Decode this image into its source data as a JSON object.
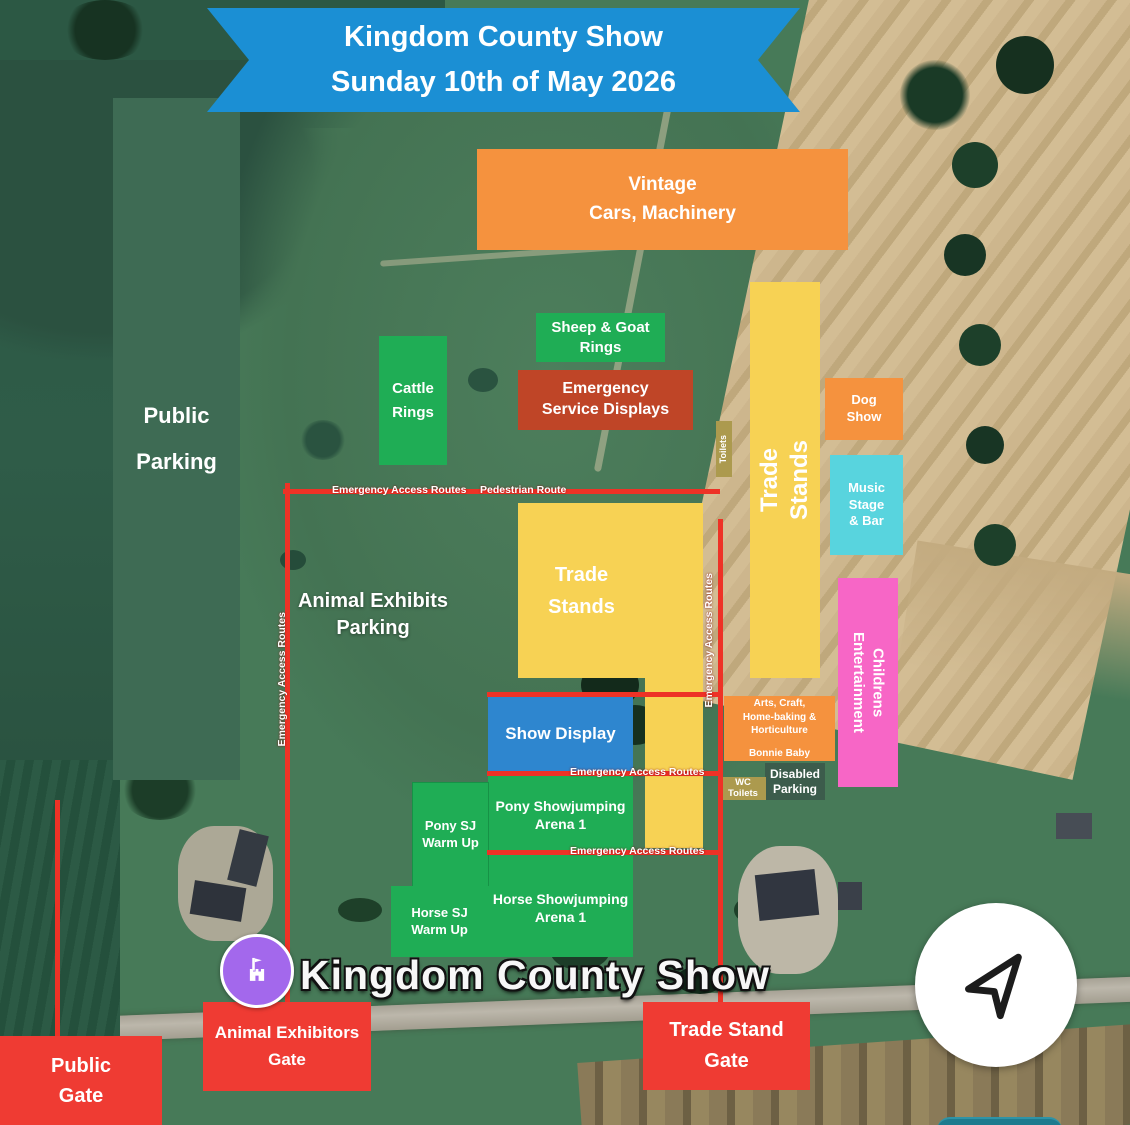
{
  "banner": {
    "line1": "Kingdom County Show",
    "line2": "Sunday 10th of May 2026",
    "color": "#1b8fd4"
  },
  "zones": {
    "public_parking": {
      "line1": "Public",
      "line2": "Parking",
      "color": "#3e6b54"
    },
    "vintage": {
      "line1": "Vintage",
      "line2": "Cars, Machinery",
      "color": "#f5923e"
    },
    "cattle_rings": {
      "line1": "Cattle",
      "line2": "Rings",
      "color": "#1fad55"
    },
    "sheep_goat_rings": {
      "line1": "Sheep & Goat",
      "line2": "Rings",
      "color": "#1fad55"
    },
    "emergency_service_displays": {
      "line1": "Emergency",
      "line2": "Service Displays",
      "color": "#bf4527"
    },
    "toilets": {
      "label": "Toilets",
      "color": "#ac9a4e"
    },
    "trade_stands_right": {
      "line1": "Trade",
      "line2": "Stands",
      "color": "#f7d254"
    },
    "dog_show": {
      "line1": "Dog",
      "line2": "Show",
      "color": "#f5923e"
    },
    "music_stage_bar": {
      "line1": "Music Stage",
      "line2": "& Bar",
      "color": "#58d4de"
    },
    "childrens_entertainment": {
      "line1": "Childrens",
      "line2": "Entertainment",
      "color": "#f766c6"
    },
    "trade_stands_main": {
      "line1": "Trade",
      "line2": "Stands",
      "color": "#f7d254"
    },
    "show_display": {
      "label": "Show Display",
      "color": "#2e86cf"
    },
    "arts_craft": {
      "line1": "Arts, Craft,",
      "line2": "Home-baking & Horticulture",
      "line3": "Bonnie Baby",
      "color": "#f5923e"
    },
    "disabled_parking": {
      "line1": "Disabled",
      "line2": "Parking",
      "color": "#3c5c4c"
    },
    "wc_toilets": {
      "line1": "WC",
      "line2": "Toilets",
      "color": "#ac9a4e"
    },
    "pony_sj_warm_up": {
      "line1": "Pony SJ",
      "line2": "Warm Up",
      "color": "#1fad55"
    },
    "pony_showjumping_arena": {
      "line1": "Pony Showjumping",
      "line2": "Arena 1",
      "color": "#1fad55"
    },
    "horse_sj_warm_up": {
      "line1": "Horse SJ",
      "line2": "Warm Up",
      "color": "#1fad55"
    },
    "horse_showjumping_arena": {
      "line1": "Horse Showjumping",
      "line2": "Arena 1",
      "color": "#1fad55"
    }
  },
  "gates": {
    "public": {
      "line1": "Public",
      "line2": "Gate",
      "color": "#ef3b33"
    },
    "animal_exhibitors": {
      "line1": "Animal Exhibitors",
      "line2": "Gate",
      "color": "#ef3b33"
    },
    "trade_stand": {
      "line1": "Trade Stand",
      "line2": "Gate",
      "color": "#ef3b33"
    }
  },
  "routes": {
    "color": "#ee3226",
    "emergency_access": "Emergency Access Routes",
    "pedestrian": "Pedestrian Route"
  },
  "map_labels": {
    "animal_exhibits_parking_line1": "Animal Exhibits",
    "animal_exhibits_parking_line2": "Parking",
    "place_name": "Kingdom County Show"
  },
  "icons": {
    "place_pin": "castle-attraction-icon",
    "place_pin_color": "#a368ec",
    "compass": "navigation-arrow-icon",
    "map_control_color": "#1d7b8e"
  }
}
